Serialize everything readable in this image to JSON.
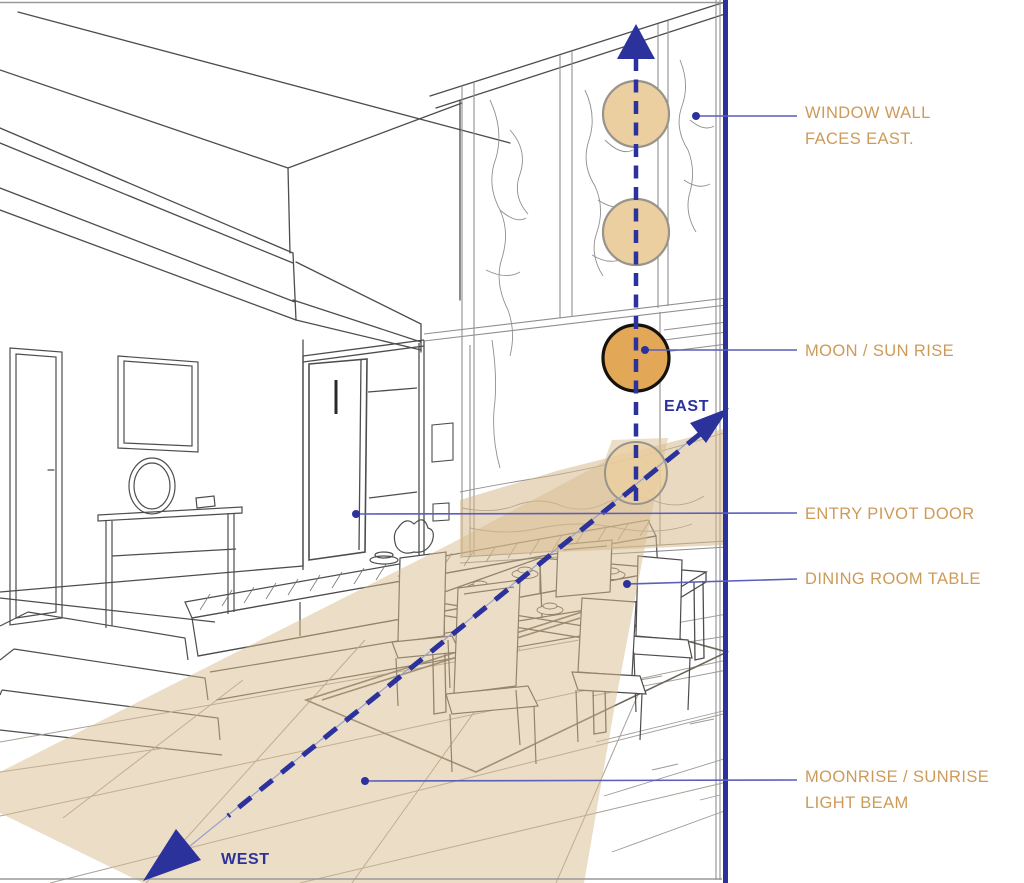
{
  "diagram": {
    "subject": "interior perspective of double-height living and dining room with east-facing window wall",
    "direction_markers": [
      {
        "label": "EAST"
      },
      {
        "label": "WEST"
      }
    ],
    "sun_positions": [
      {
        "name": "moon-sun-high",
        "style": "light-tan"
      },
      {
        "name": "moon-sun-upper",
        "style": "light-tan"
      },
      {
        "name": "moon-sun-rise",
        "style": "orange-highlighted"
      },
      {
        "name": "moon-sun-horizon",
        "style": "light-tan-translucent"
      }
    ],
    "colors": {
      "annotation_text": "#CE9A58",
      "diagram_blue": "#2B329B",
      "leader_line": "#5B5FBA",
      "sun_light_fill": "#ECCFA0",
      "sun_rise_fill": "#E2A757",
      "light_beam_fill": "#E9DCC2",
      "line_art": "#4D4D4D"
    }
  },
  "annotations": [
    {
      "text": "WINDOW WALL\nFACES EAST."
    },
    {
      "text": "MOON / SUN RISE"
    },
    {
      "text": "ENTRY PIVOT DOOR"
    },
    {
      "text": "DINING ROOM TABLE"
    },
    {
      "text": "MOONRISE / SUNRISE\nLIGHT BEAM"
    }
  ]
}
